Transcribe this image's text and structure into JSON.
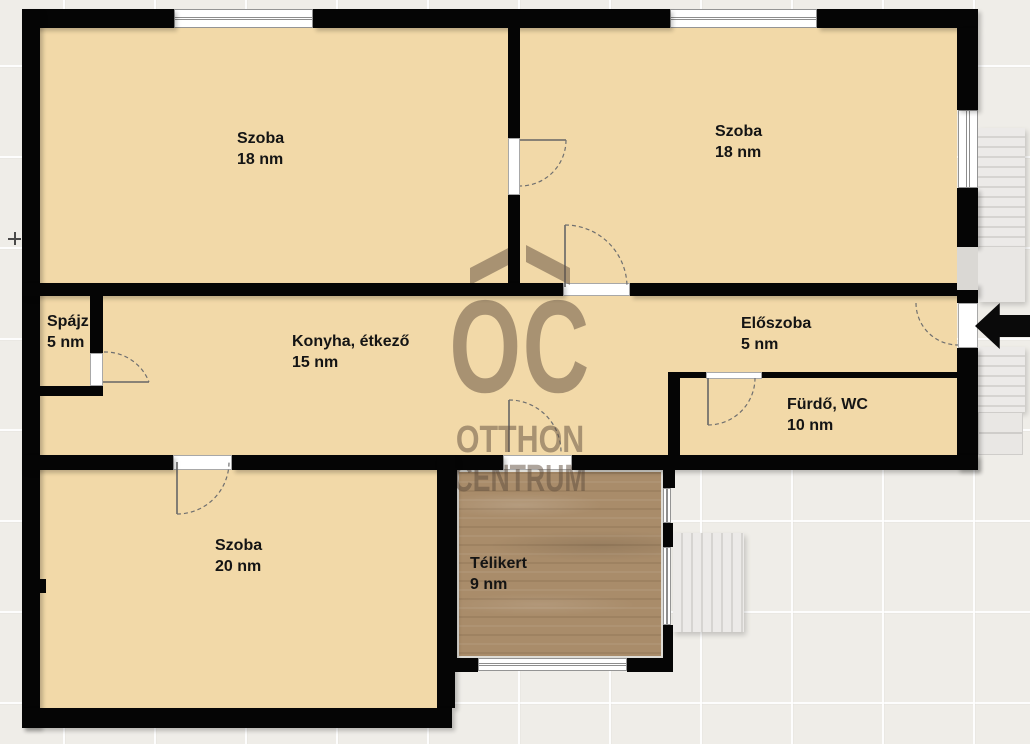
{
  "floorplan": {
    "rooms": [
      {
        "label": "Szoba",
        "area": "18 nm"
      },
      {
        "label": "Szoba",
        "area": "18 nm"
      },
      {
        "label": "Spájz",
        "area": "5 nm"
      },
      {
        "label": "Konyha, étkező",
        "area": "15 nm"
      },
      {
        "label": "Előszoba",
        "area": "5 nm"
      },
      {
        "label": "Fürdő, WC",
        "area": "10 nm"
      },
      {
        "label": "Szoba",
        "area": "20 nm"
      },
      {
        "label": "Télikert",
        "area": "9 nm"
      }
    ],
    "watermark": {
      "monogram": "OC",
      "line1": "OTTHON",
      "line2": "CENTRUM"
    },
    "colors": {
      "wall": "#050505",
      "room_floor": "#f2d9a8",
      "wood_floor": "#a98c6a",
      "watermark": "#5e4b3c",
      "stairs": "#e9e7e4",
      "background": "#efede8",
      "entry_arrow": "#0a0a0a"
    }
  }
}
